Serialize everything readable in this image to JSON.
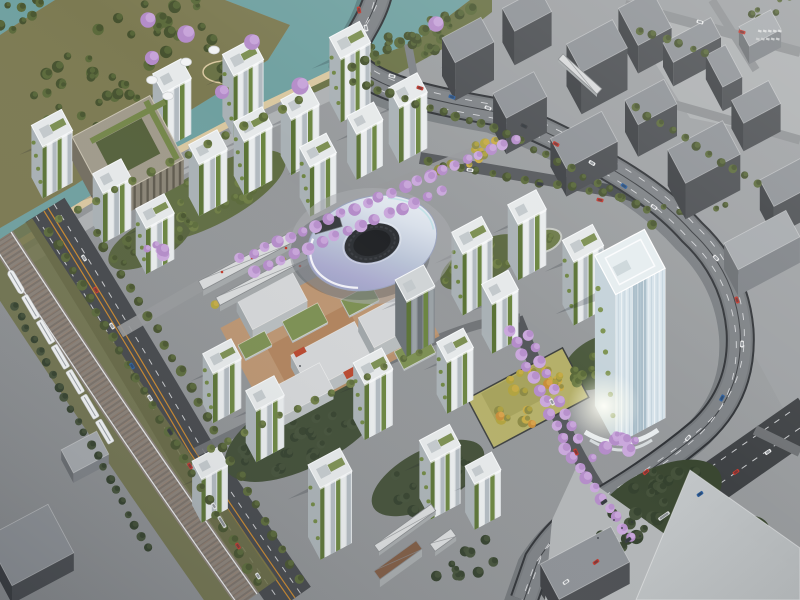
{
  "meta": {
    "type": "architectural-aerial-rendering",
    "view": "birds-eye-oblique",
    "subject": "eco-district masterplan with green residential towers, ring-shaped cultural building and landmark office tower"
  },
  "scene": {
    "elements": [
      "river",
      "waterfront-park-peninsula",
      "sandy-beach",
      "esplanade",
      "purple-blossom-trees",
      "elevated-highway",
      "elevated-rail-viaduct",
      "high-speed-train",
      "tree-lined-boulevard",
      "residential-towers-green-facades",
      "perimeter-slab-block",
      "ring-building",
      "podium-courtyard-buildings",
      "transit-canopies",
      "landmark-office-tower",
      "terraced-lawn-park",
      "pedestrian-bridges",
      "context-city-blocks",
      "plaza",
      "cars",
      "bus",
      "pond-garden"
    ]
  },
  "palette": {
    "water": "#6fa0a0",
    "waterDeep": "#5d8f90",
    "sand": "#d9c7a0",
    "parkGround": "#7c7a52",
    "bank": "#6a7246",
    "grass": "#6d7045",
    "treeDark": "#46522f",
    "treeMid": "#5b6a3b",
    "treeLight": "#6f7e46",
    "treeForest": "#33402d",
    "treeForest2": "#44513a",
    "treeYellow": "#b1a33f",
    "treeGold": "#c9ab46",
    "treeOliveY": "#8c8a46",
    "treeOrange": "#c78d3a",
    "treePurple": "#b48cc9",
    "treePurpleLt": "#caa8dc",
    "base": "#94979a",
    "neGround": "#9da0a3",
    "plaza": "#b2b5b7",
    "esplanade": "#aeb1b3",
    "asphalt": "#45484c",
    "roadMinor": "#55585c",
    "laneOrange": "#c8872e",
    "laneWhite": "#e8eaec",
    "hwyCase": "#303337",
    "hwyDeck": "#73777b",
    "hwyDeck2": "#7d8185",
    "ballast": "#8a8178",
    "ballastDk": "#6f675f",
    "ballastRd": "#9c826d",
    "twRoof": "#e6e9ea",
    "twFront": "#dfe3e5",
    "twSide": "#a9b1b5",
    "twLite": "#e9eced",
    "twDark": "#b0b8bc",
    "gA": "#5b7336",
    "gB": "#6b8540",
    "gC": "#4f6531",
    "podGreen": "#7c8f52",
    "dkFront": "#83898e",
    "dkSide": "#6b7277",
    "dkRoof": "#d0d4d6",
    "ctxRoof": "#8d9196",
    "ctxFront": "#4b4e52",
    "ctxSide": "#3c3f43",
    "ctxLRoof": "#a5a9ad",
    "ctxLFront": "#7e8287",
    "ctxLSide": "#696d71",
    "podRoof": "#d3d5d7",
    "plazaTan": "#c2946a",
    "plazaTan2": "#a87850",
    "accentRed": "#b9472e",
    "canopy": "#d8dadb",
    "canopyStripe": "#86898c",
    "bridgeBrown": "#7d5a43",
    "ringDark": "#2f3236",
    "bowl": "#222427",
    "lmFront": "#d7e3ea",
    "lmFin": "#ffffff",
    "lmFin2": "#b6c8d3",
    "lmSide": "#c5d3da",
    "lmGlass": "#9db3c1",
    "lmRoof": "#e6edf0",
    "uRoof": "#a09a8b",
    "uFront": "#8a8476",
    "uWin": "#5f5a4e",
    "uCourt": "#55613c",
    "carWhite": "#e9eaeb",
    "carRed": "#c03a30",
    "carBlue": "#2d5f9e",
    "carDark": "#393c40",
    "bus": "#d9dadb",
    "train": "#f2f4f5",
    "trainLine": "#9aa0a4",
    "lawn": "#b5b06a",
    "lawn2": "#a6a25c",
    "pond": "#6d7b4a"
  }
}
